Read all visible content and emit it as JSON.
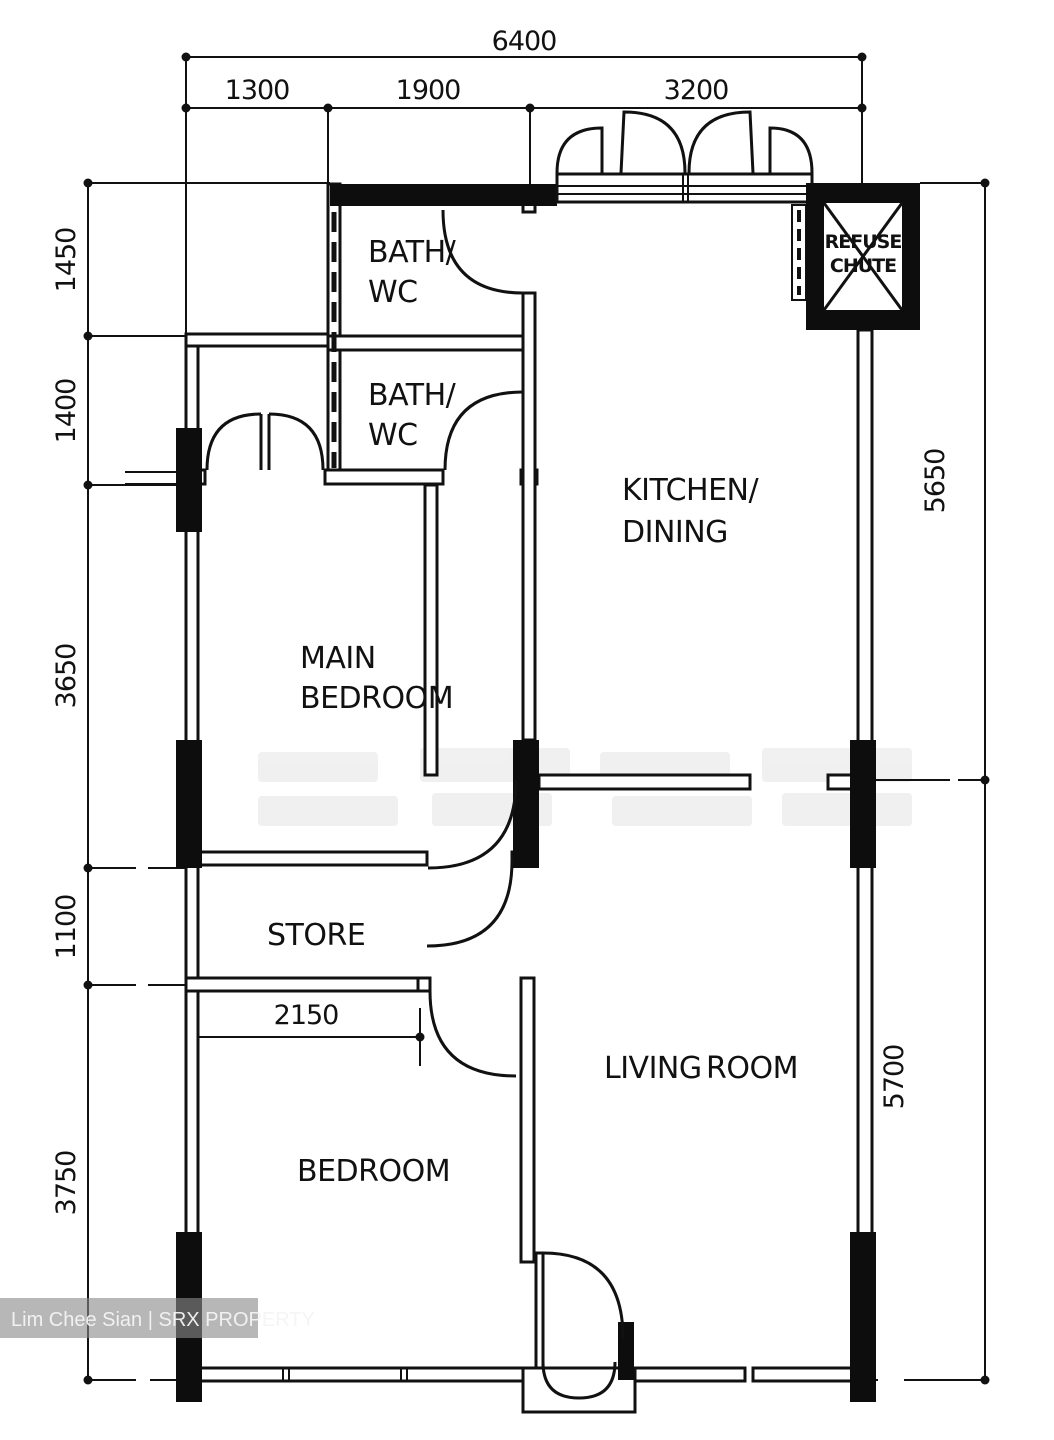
{
  "watermark": {
    "label": "Lim Chee Sian | SRX PROPERTY"
  },
  "rooms": {
    "bath_top": {
      "line1": "BATH/",
      "line2": "WC"
    },
    "bath_mid": {
      "line1": "BATH/",
      "line2": "WC"
    },
    "kitchen": {
      "line1": "KITCHEN/",
      "line2": "DINING"
    },
    "main_bedroom": {
      "line1": "MAIN",
      "line2": "BEDROOM"
    },
    "store": {
      "label": "STORE"
    },
    "bedroom": {
      "label": "BEDROOM"
    },
    "living_room": {
      "line1": "LIVING",
      "line2": "ROOM"
    },
    "refuse_chute": {
      "line1": "REFUSE",
      "line2": "CHUTE"
    }
  },
  "dimensions": {
    "top_total": "6400",
    "top_left": "1300",
    "top_mid": "1900",
    "top_right": "3200",
    "left_1": "1450",
    "left_2": "1400",
    "left_3": "3650",
    "left_4": "1100",
    "left_5": "3750",
    "right_top": "5650",
    "right_bottom": "5700",
    "store_width": "2150"
  },
  "colors": {
    "line": "#111111",
    "wall_fill": "#0d0d0d",
    "background": "#ffffff",
    "watermark_bg": "#8a8a8a",
    "watermark_text": "#f5f5f5"
  }
}
